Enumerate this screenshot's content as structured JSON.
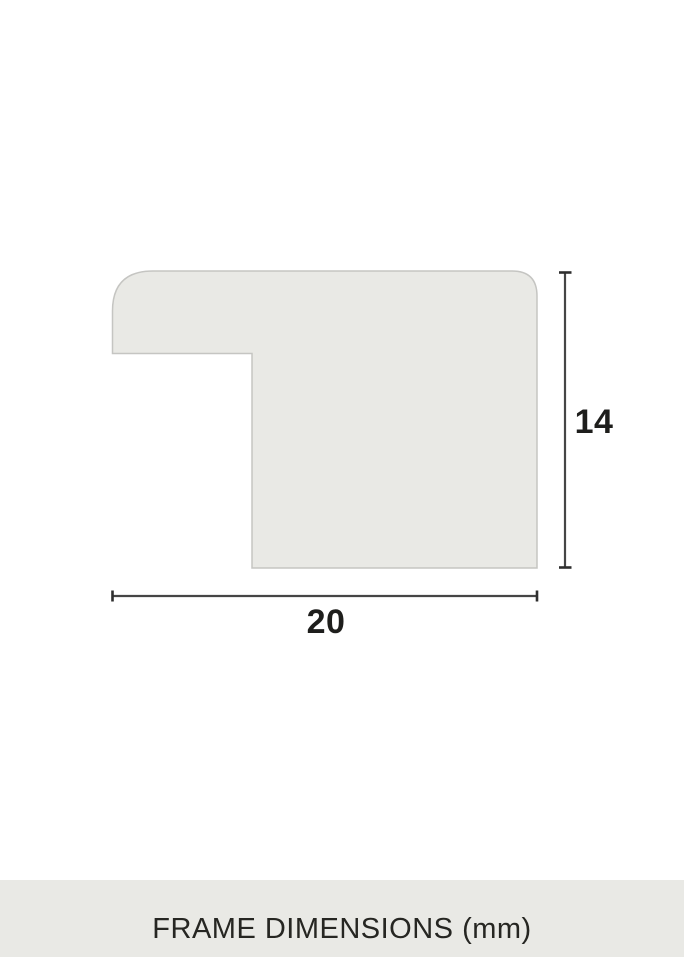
{
  "diagram": {
    "height_label": "14",
    "width_label": "20",
    "colors": {
      "profile_fill": "#e9e9e5",
      "profile_stroke": "#c5c5c2",
      "dimension_line": "#454545",
      "dimension_text": "#1e1e1c"
    }
  },
  "footer": {
    "title": "FRAME DIMENSIONS (mm)",
    "background": "#e9e9e5",
    "text_color": "#262622"
  }
}
